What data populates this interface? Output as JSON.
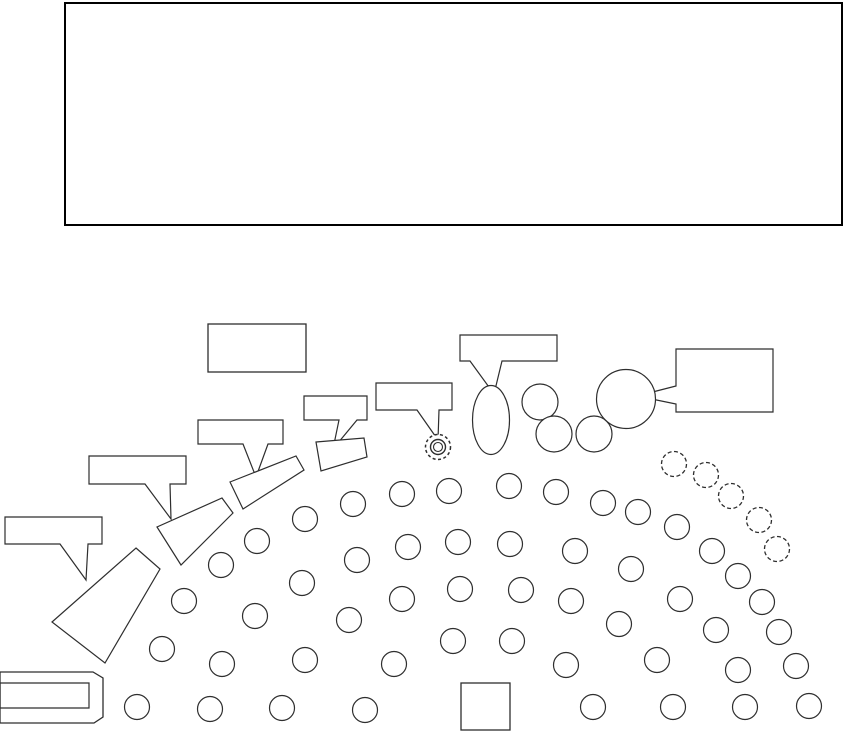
{
  "diagram": {
    "description": "orchestra-seating-plan",
    "canvas": {
      "width": 846,
      "height": 733
    },
    "colors": {
      "background": "#ffffff",
      "line": "#2e2e2e",
      "stage_line": "#000000",
      "shape_fill": "#ffffff"
    },
    "stage": {
      "x": 65,
      "y": 3,
      "width": 777,
      "height": 222
    },
    "label_box": {
      "x": 208,
      "y": 324,
      "width": 98,
      "height": 48
    },
    "podium": {
      "x": 461,
      "y": 683,
      "width": 49,
      "height": 47
    },
    "callouts": [
      {
        "id": "callout-label-1",
        "points": [
          [
            5,
            517
          ],
          [
            102,
            517
          ],
          [
            102,
            544
          ],
          [
            88,
            544
          ],
          [
            86,
            580
          ],
          [
            60,
            544
          ],
          [
            5,
            544
          ]
        ]
      },
      {
        "id": "callout-label-2",
        "points": [
          [
            89,
            456
          ],
          [
            186,
            456
          ],
          [
            186,
            484
          ],
          [
            170,
            484
          ],
          [
            171,
            519
          ],
          [
            145,
            484
          ],
          [
            89,
            484
          ]
        ]
      },
      {
        "id": "callout-label-3",
        "points": [
          [
            198,
            420
          ],
          [
            283,
            420
          ],
          [
            283,
            444
          ],
          [
            268,
            444
          ],
          [
            256,
            477
          ],
          [
            243,
            444
          ],
          [
            198,
            444
          ]
        ]
      },
      {
        "id": "callout-label-4",
        "points": [
          [
            304,
            396
          ],
          [
            367,
            396
          ],
          [
            367,
            420
          ],
          [
            357,
            420
          ],
          [
            333,
            449
          ],
          [
            339,
            420
          ],
          [
            304,
            420
          ]
        ]
      },
      {
        "id": "callout-label-5",
        "points": [
          [
            376,
            383
          ],
          [
            452,
            383
          ],
          [
            452,
            410
          ],
          [
            439,
            410
          ],
          [
            438,
            440
          ],
          [
            417,
            410
          ],
          [
            376,
            410
          ]
        ]
      },
      {
        "id": "callout-label-6",
        "points": [
          [
            460,
            335
          ],
          [
            557,
            335
          ],
          [
            557,
            361
          ],
          [
            502,
            361
          ],
          [
            494,
            394
          ],
          [
            470,
            361
          ],
          [
            460,
            361
          ]
        ]
      },
      {
        "id": "callout-label-7",
        "points": [
          [
            676,
            349
          ],
          [
            773,
            349
          ],
          [
            773,
            412
          ],
          [
            676,
            412
          ],
          [
            676,
            404
          ],
          [
            637,
            396
          ],
          [
            676,
            386
          ]
        ]
      }
    ],
    "sections": [
      {
        "id": "section-trapezoid",
        "points": [
          [
            136,
            548
          ],
          [
            160,
            569
          ],
          [
            105,
            663
          ],
          [
            52,
            622
          ]
        ]
      },
      {
        "id": "section-angled-1",
        "points": [
          [
            222,
            498
          ],
          [
            233,
            513
          ],
          [
            181,
            565
          ],
          [
            157,
            527
          ]
        ]
      },
      {
        "id": "section-angled-2",
        "points": [
          [
            230,
            482
          ],
          [
            296,
            456
          ],
          [
            304,
            470
          ],
          [
            243,
            509
          ]
        ]
      },
      {
        "id": "section-angled-3",
        "points": [
          [
            316,
            442
          ],
          [
            364,
            438
          ],
          [
            367,
            457
          ],
          [
            321,
            471
          ]
        ]
      }
    ],
    "piano": {
      "outer": [
        [
          0,
          672
        ],
        [
          93,
          672
        ],
        [
          103,
          678
        ],
        [
          103,
          717
        ],
        [
          94,
          723
        ],
        [
          0,
          723
        ]
      ],
      "inner": [
        [
          0,
          683
        ],
        [
          89,
          683
        ],
        [
          89,
          708
        ],
        [
          0,
          708
        ]
      ]
    },
    "seats": {
      "radius": 12.5,
      "solid": [
        [
          221,
          565
        ],
        [
          257,
          541
        ],
        [
          305,
          519
        ],
        [
          353,
          504
        ],
        [
          402,
          494
        ],
        [
          449,
          491
        ],
        [
          509,
          486
        ],
        [
          556,
          492
        ],
        [
          603,
          503
        ],
        [
          638,
          512
        ],
        [
          184,
          601
        ],
        [
          302,
          583
        ],
        [
          357,
          560
        ],
        [
          408,
          547
        ],
        [
          458,
          542
        ],
        [
          510,
          544
        ],
        [
          575,
          551
        ],
        [
          631,
          569
        ],
        [
          677,
          527
        ],
        [
          712,
          551
        ],
        [
          738,
          576
        ],
        [
          162,
          649
        ],
        [
          255,
          616
        ],
        [
          349,
          620
        ],
        [
          402,
          599
        ],
        [
          460,
          589
        ],
        [
          521,
          590
        ],
        [
          571,
          601
        ],
        [
          619,
          624
        ],
        [
          680,
          599
        ],
        [
          762,
          602
        ],
        [
          716,
          630
        ],
        [
          779,
          632
        ],
        [
          222,
          664
        ],
        [
          305,
          660
        ],
        [
          394,
          664
        ],
        [
          453,
          641
        ],
        [
          512,
          641
        ],
        [
          566,
          665
        ],
        [
          657,
          660
        ],
        [
          738,
          670
        ],
        [
          796,
          666
        ],
        [
          137,
          707
        ],
        [
          210,
          709
        ],
        [
          282,
          708
        ],
        [
          365,
          710
        ],
        [
          593,
          707
        ],
        [
          673,
          707
        ],
        [
          745,
          707
        ],
        [
          809,
          706
        ]
      ],
      "dashed": [
        [
          674,
          464
        ],
        [
          706,
          475
        ],
        [
          731,
          496
        ],
        [
          759,
          520
        ],
        [
          777,
          549
        ]
      ]
    },
    "medium_circles": {
      "radius": 18,
      "centers": [
        [
          540,
          402
        ],
        [
          554,
          434
        ],
        [
          594,
          434
        ]
      ]
    },
    "large_circle": {
      "cx": 626,
      "cy": 399,
      "r": 29.5
    },
    "soloist_ellipse": {
      "cx": 491,
      "cy": 420,
      "rx": 18.5,
      "ry": 34.5
    },
    "target_symbol": {
      "cx": 438,
      "cy": 447,
      "outer_r": 12.5,
      "mid_r": 7.5,
      "inner_r": 4.5
    }
  }
}
